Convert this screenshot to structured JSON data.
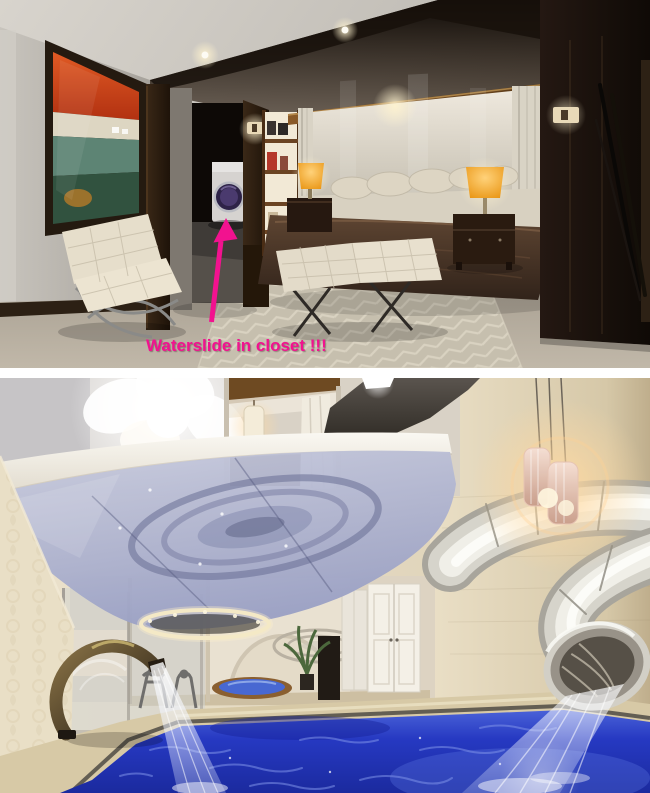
{
  "annotation": {
    "text": "Waterslide in closet !!!",
    "color": "#f2128f",
    "arrow_direction": "up"
  },
  "photos": {
    "top": {
      "name": "bedroom-interior-render"
    },
    "bottom": {
      "name": "indoor-pool-waterslide-render"
    }
  },
  "palette": {
    "annotation_pink": "#f2128f",
    "pool_blue": "#2639c2",
    "dark_wood": "#241812",
    "travertine_beige": "#e4dac2",
    "lamp_orange": "#e8950f",
    "chrome_slide": "#d6d4cb",
    "background_white": "#ffffff"
  }
}
